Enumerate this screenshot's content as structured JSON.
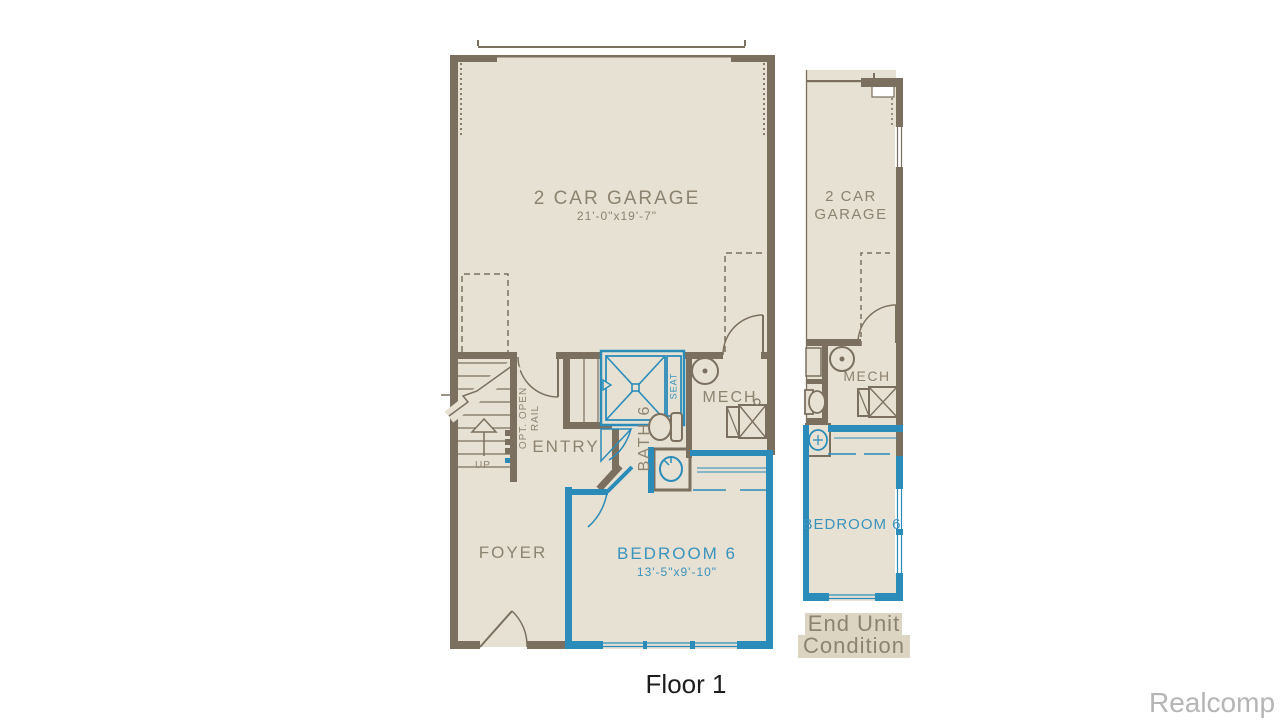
{
  "colors": {
    "page_bg": "#ffffff",
    "wall": "#7b7060",
    "floor": "#e6e1d2",
    "accent": "#2b8cba",
    "label": "#8d8371",
    "accent_label": "#3a93bd",
    "highlight": "#dbd5c1",
    "caption": "#1d1d1f",
    "watermark": "#b5b5b5"
  },
  "main_plan": {
    "garage": {
      "label": "2 CAR GARAGE",
      "dims": "21'-0\"x19'-7\""
    },
    "stairs": {
      "up": "UP",
      "note_line1": "OPT. OPEN",
      "note_line2": "RAIL"
    },
    "entry": {
      "label": "ENTRY"
    },
    "bath": {
      "label": "BATH 6",
      "seat": "SEAT"
    },
    "mech": {
      "label": "MECH"
    },
    "foyer": {
      "label": "FOYER"
    },
    "bedroom": {
      "label": "BEDROOM 6",
      "dims": "13'-5\"x9'-10\""
    }
  },
  "end_unit_plan": {
    "garage_line1": "2 CAR",
    "garage_line2": "GARAGE",
    "mech_label": "MECH",
    "bedroom_label": "BEDROOM 6",
    "caption_line1": "End Unit",
    "caption_line2": "Condition"
  },
  "floor_caption": "Floor 1",
  "watermark": "Realcomp"
}
